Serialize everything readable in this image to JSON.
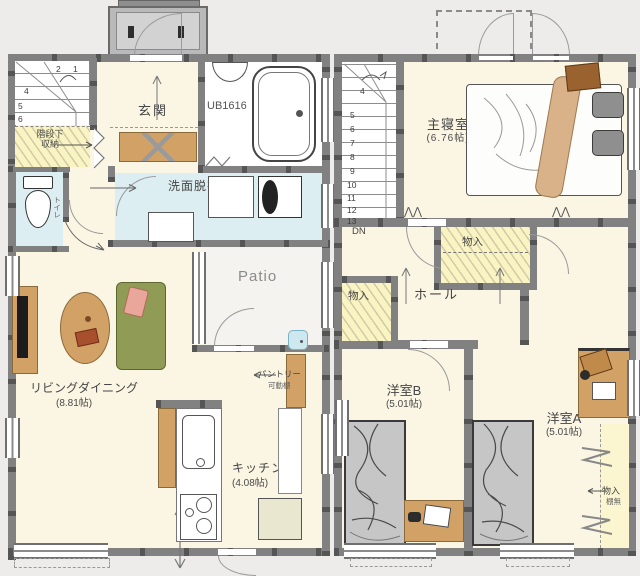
{
  "plan_title": "2-story house floor plan",
  "floor1": {
    "porch": {
      "name": "entrance porch"
    },
    "genkan": {
      "label": "玄関"
    },
    "bath": {
      "label": "UB1616"
    },
    "washroom": {
      "label": "洗面脱衣室"
    },
    "stairs": {
      "numbers": [
        "2",
        "1",
        "4",
        "5",
        "6"
      ]
    },
    "under_stairs_storage": {
      "line1": "階段下",
      "line2": "収納"
    },
    "toilet": {
      "label": "トイレ"
    },
    "living": {
      "label": "リビングダイニング",
      "size": "(8.81帖)"
    },
    "kitchen": {
      "label": "キッチン",
      "size": "(4.08帖)"
    },
    "pantry": {
      "label": "パントリー",
      "note": "可動棚"
    },
    "patio": {
      "label": "Patio"
    }
  },
  "floor2": {
    "stairs": {
      "dn": "DN",
      "numbers": [
        "4",
        "5",
        "6",
        "7",
        "8",
        "9",
        "10",
        "11",
        "12",
        "13"
      ]
    },
    "master": {
      "label": "主寝室",
      "size": "(6.76帖)"
    },
    "closet_top": {
      "label": "物入"
    },
    "closet_left": {
      "label": "物入"
    },
    "hall": {
      "label": "ホール"
    },
    "room_b": {
      "label": "洋室B",
      "size": "(5.01帖)"
    },
    "room_a": {
      "label": "洋室A",
      "size": "(5.01帖)"
    },
    "closet_right": {
      "label": "物入",
      "note": "棚無"
    }
  },
  "colors": {
    "wall": "#818181",
    "wall_post": "#555555",
    "floor_cream": "#fbf5e3",
    "wet_area_blue": "#dceef2",
    "storage_yellow": "#faf3c2",
    "furniture_tan": "#d2a165",
    "sofa_olive": "#909b55",
    "bed_gray": "#c6c6c6"
  }
}
